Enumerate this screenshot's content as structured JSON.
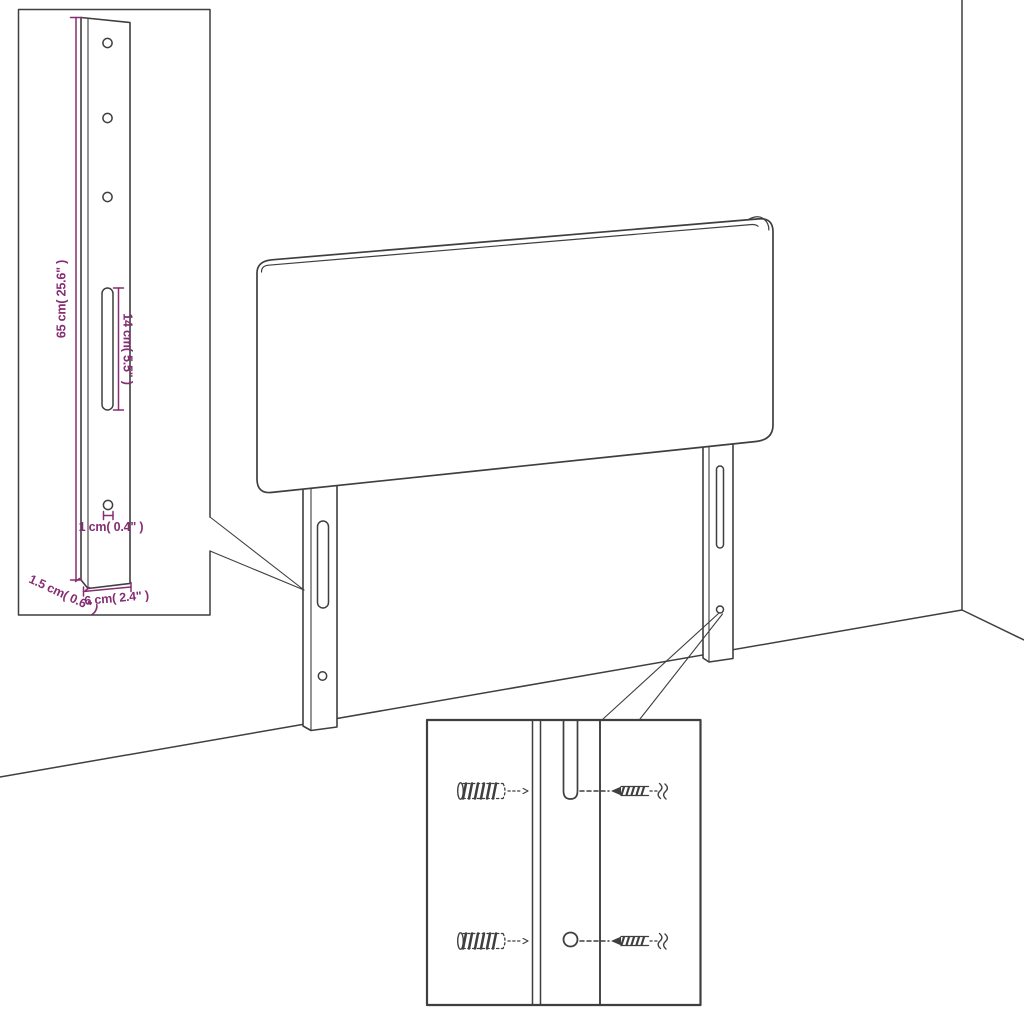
{
  "colors": {
    "paper": "#ffffff",
    "line": "#3f3f3f",
    "dimension": "#862d74"
  },
  "insets": {
    "bracket_detail": {
      "dimensions": {
        "height": "65 cm( 25.6\" )",
        "slot_length": "14 cm( 5.5\" )",
        "hole_diameter": "1 cm( 0.4\" )",
        "thickness": "1.5 cm( 0.6\" )",
        "width": "6 cm( 2.4\" )"
      }
    },
    "hardware_detail": {
      "icons": {
        "wall_plug": "ribbed-wall-anchor",
        "screw": "wood-screw"
      }
    }
  }
}
